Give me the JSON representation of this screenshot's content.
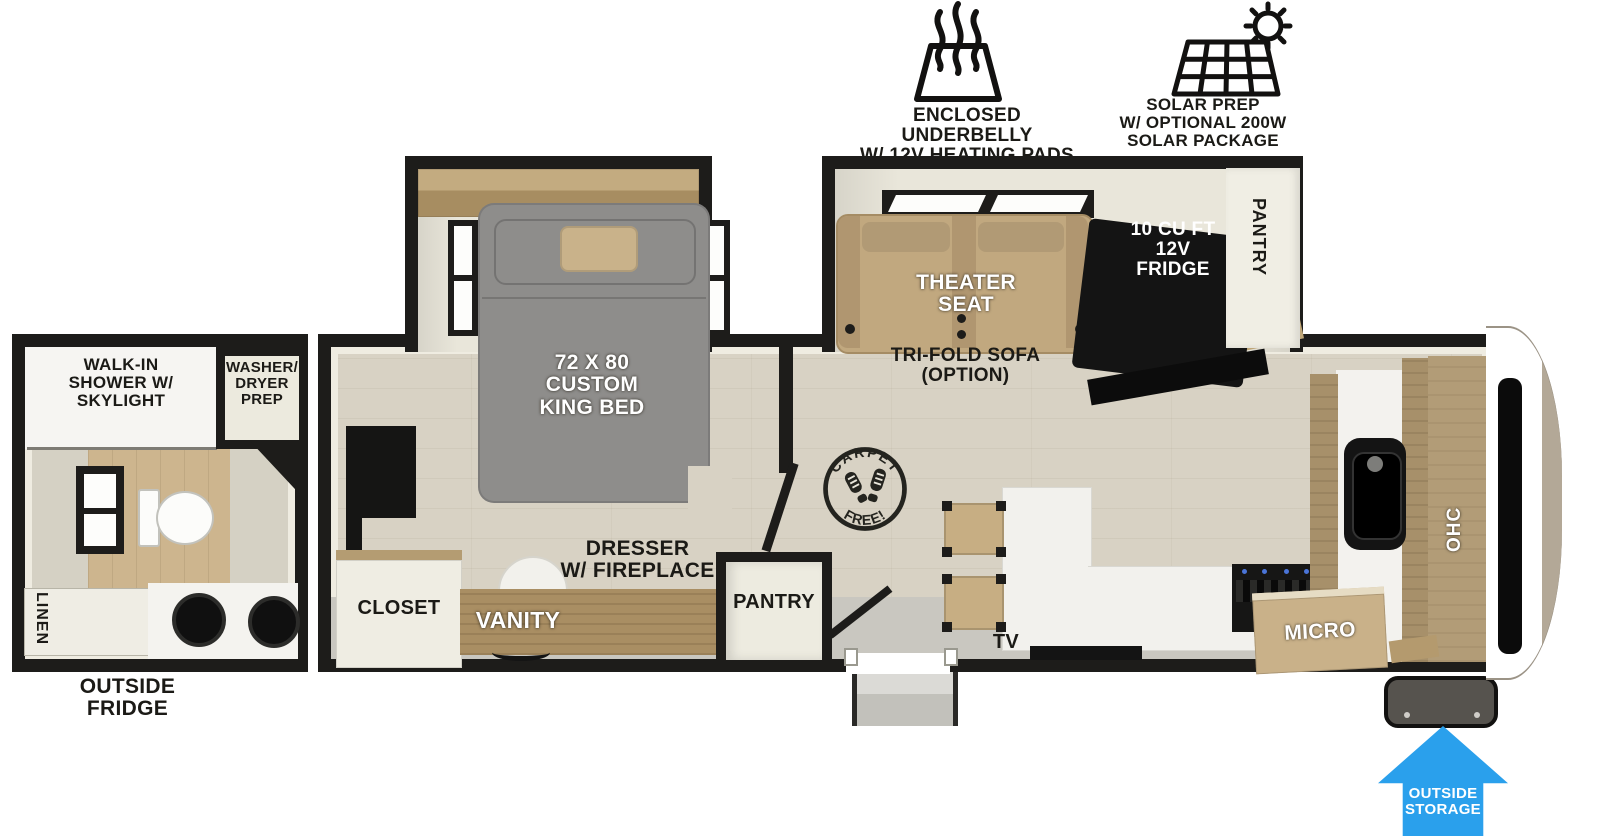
{
  "features": {
    "underbelly_label": "ENCLOSED UNDERBELLY\nW/ 12V HEATING PADS",
    "solar_label": "SOLAR PREP\nW/ OPTIONAL 200W\nSOLAR PACKAGE"
  },
  "bathroom": {
    "shower_label": "WALK-IN\nSHOWER W/\nSKYLIGHT",
    "washer_dryer_label": "WASHER/\nDRYER\nPREP",
    "linen_label": "LINEN"
  },
  "bedroom": {
    "bed_label": "72 X 80\nCUSTOM\nKING BED",
    "closet_label": "CLOSET",
    "vanity_label": "VANITY",
    "dresser_label": "DRESSER\nW/ FIREPLACE",
    "pantry_label": "PANTRY"
  },
  "living": {
    "theater_label": "THEATER\nSEAT",
    "sofa_label": "TRI-FOLD SOFA\n(OPTION)",
    "fridge_label": "10 CU FT\n12V\nFRIDGE",
    "pantry_label": "PANTRY",
    "carpet_top": "CARPET",
    "carpet_bottom": "FREE!",
    "tv_label": "TV",
    "micro_label": "MICRO",
    "ohc_label": "OHC"
  },
  "exterior": {
    "outside_fridge_label": "OUTSIDE\nFRIDGE",
    "outside_storage_label": "OUTSIDE\nSTORAGE"
  },
  "colors": {
    "wall": "#1d1c1a",
    "floor_wood": "#d8d2c4",
    "cabinet_wood": "#a98e63",
    "seat_tan": "#c1a87f",
    "bed_gray": "#8e8d8b",
    "counter_white": "#f3f2ee",
    "arrow_blue": "#2aa0ec"
  }
}
